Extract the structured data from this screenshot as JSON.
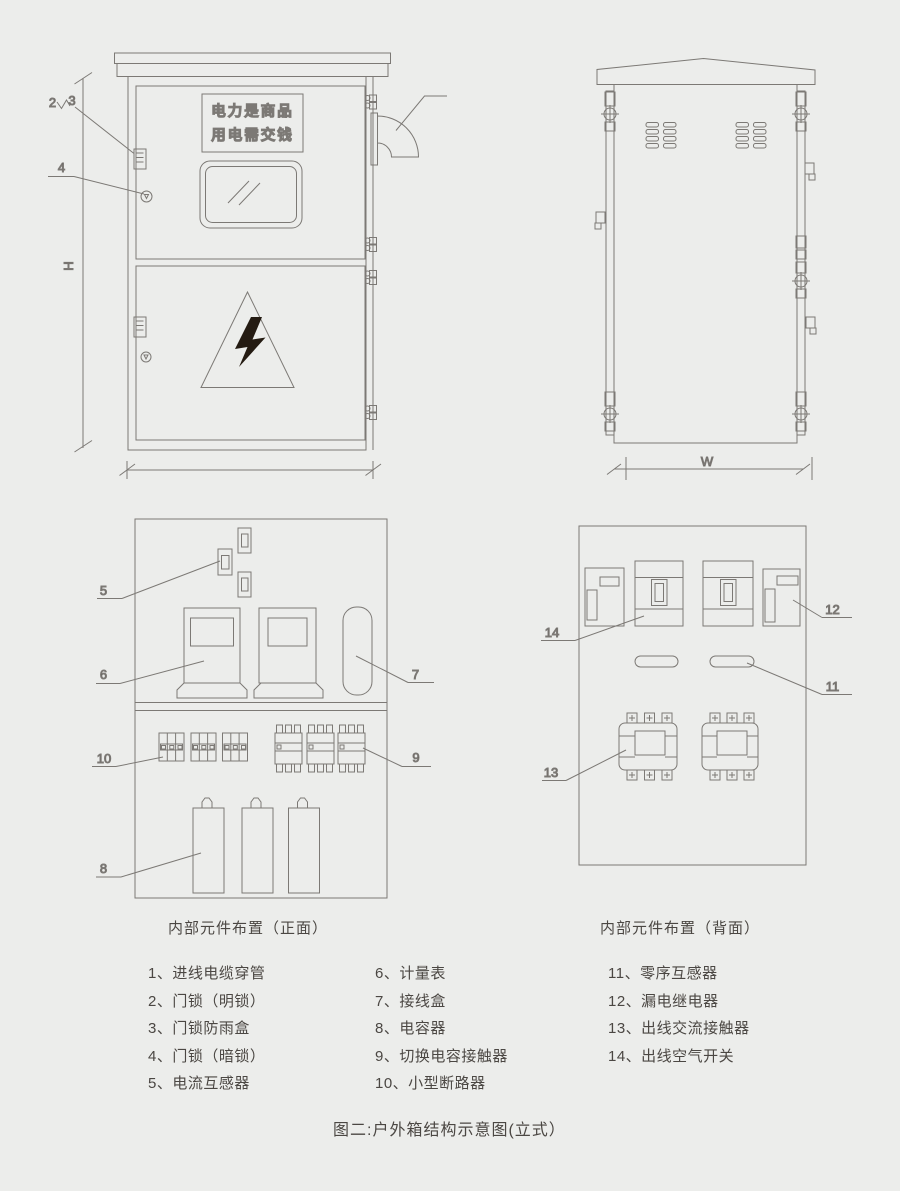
{
  "palette": {
    "background": "#ecedeb",
    "line_color": "#7c7975",
    "text_color": "#4b4743",
    "bolt_color": "#241b12"
  },
  "front_view": {
    "sign": {
      "line1": "电力是商品",
      "line2": "用电需交钱"
    },
    "height_dim_label": "H",
    "callout_2": "2",
    "callout_3": "3",
    "callout_4": "4"
  },
  "back_view": {
    "width_dim_label": "W"
  },
  "front_layout": {
    "caption": "内部元件布置（正面）",
    "callout_5": "5",
    "callout_6": "6",
    "callout_7": "7",
    "callout_8": "8",
    "callout_9": "9",
    "callout_10": "10"
  },
  "back_layout": {
    "caption": "内部元件布置（背面）",
    "callout_11": "11",
    "callout_12": "12",
    "callout_13": "13",
    "callout_14": "14"
  },
  "legend": {
    "column1": [
      "1、进线电缆穿管",
      "2、门锁（明锁）",
      "3、门锁防雨盒",
      "4、门锁（暗锁）",
      "5、电流互感器"
    ],
    "column2": [
      "6、计量表",
      "7、接线盒",
      "8、电容器",
      "9、切换电容接触器",
      "10、小型断路器"
    ],
    "column3": [
      "11、零序互感器",
      "12、漏电继电器",
      "13、出线交流接触器",
      "14、出线空气开关"
    ]
  },
  "figure_caption": "图二:户外箱结构示意图(立式）"
}
